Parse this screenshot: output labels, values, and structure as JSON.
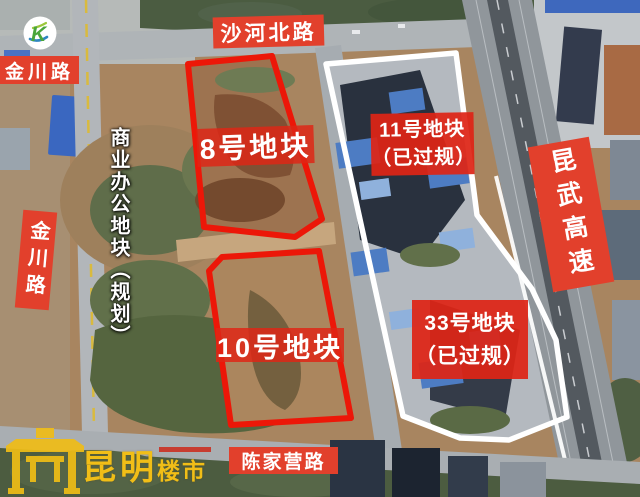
{
  "colors": {
    "annotation_red": "#e2402c",
    "outline_red": "#ec1708",
    "outline_white": "#ffffff",
    "watermark_yellow": "#f1be17"
  },
  "logo": {
    "letter": "K"
  },
  "road_labels": {
    "shahe_north_road": "沙河北路",
    "jinchuan_road_top": "金川路",
    "jinchuan_road_left": "金川路",
    "kunwu_expressway": "昆武高速",
    "chenjiaying_road": "陈家营路"
  },
  "parcel_labels": {
    "parcel_8": {
      "label": "8号地块"
    },
    "parcel_10": {
      "label": "10号地块"
    },
    "parcel_11": {
      "label": "11号地块",
      "status": "（已过规）"
    },
    "parcel_33": {
      "label": "33号地块",
      "status": "（已过规）"
    }
  },
  "annotations": {
    "planning_note": "商业办公地块（规划）"
  },
  "watermark": {
    "brand_main": "昆明",
    "brand_sub": "楼市"
  }
}
